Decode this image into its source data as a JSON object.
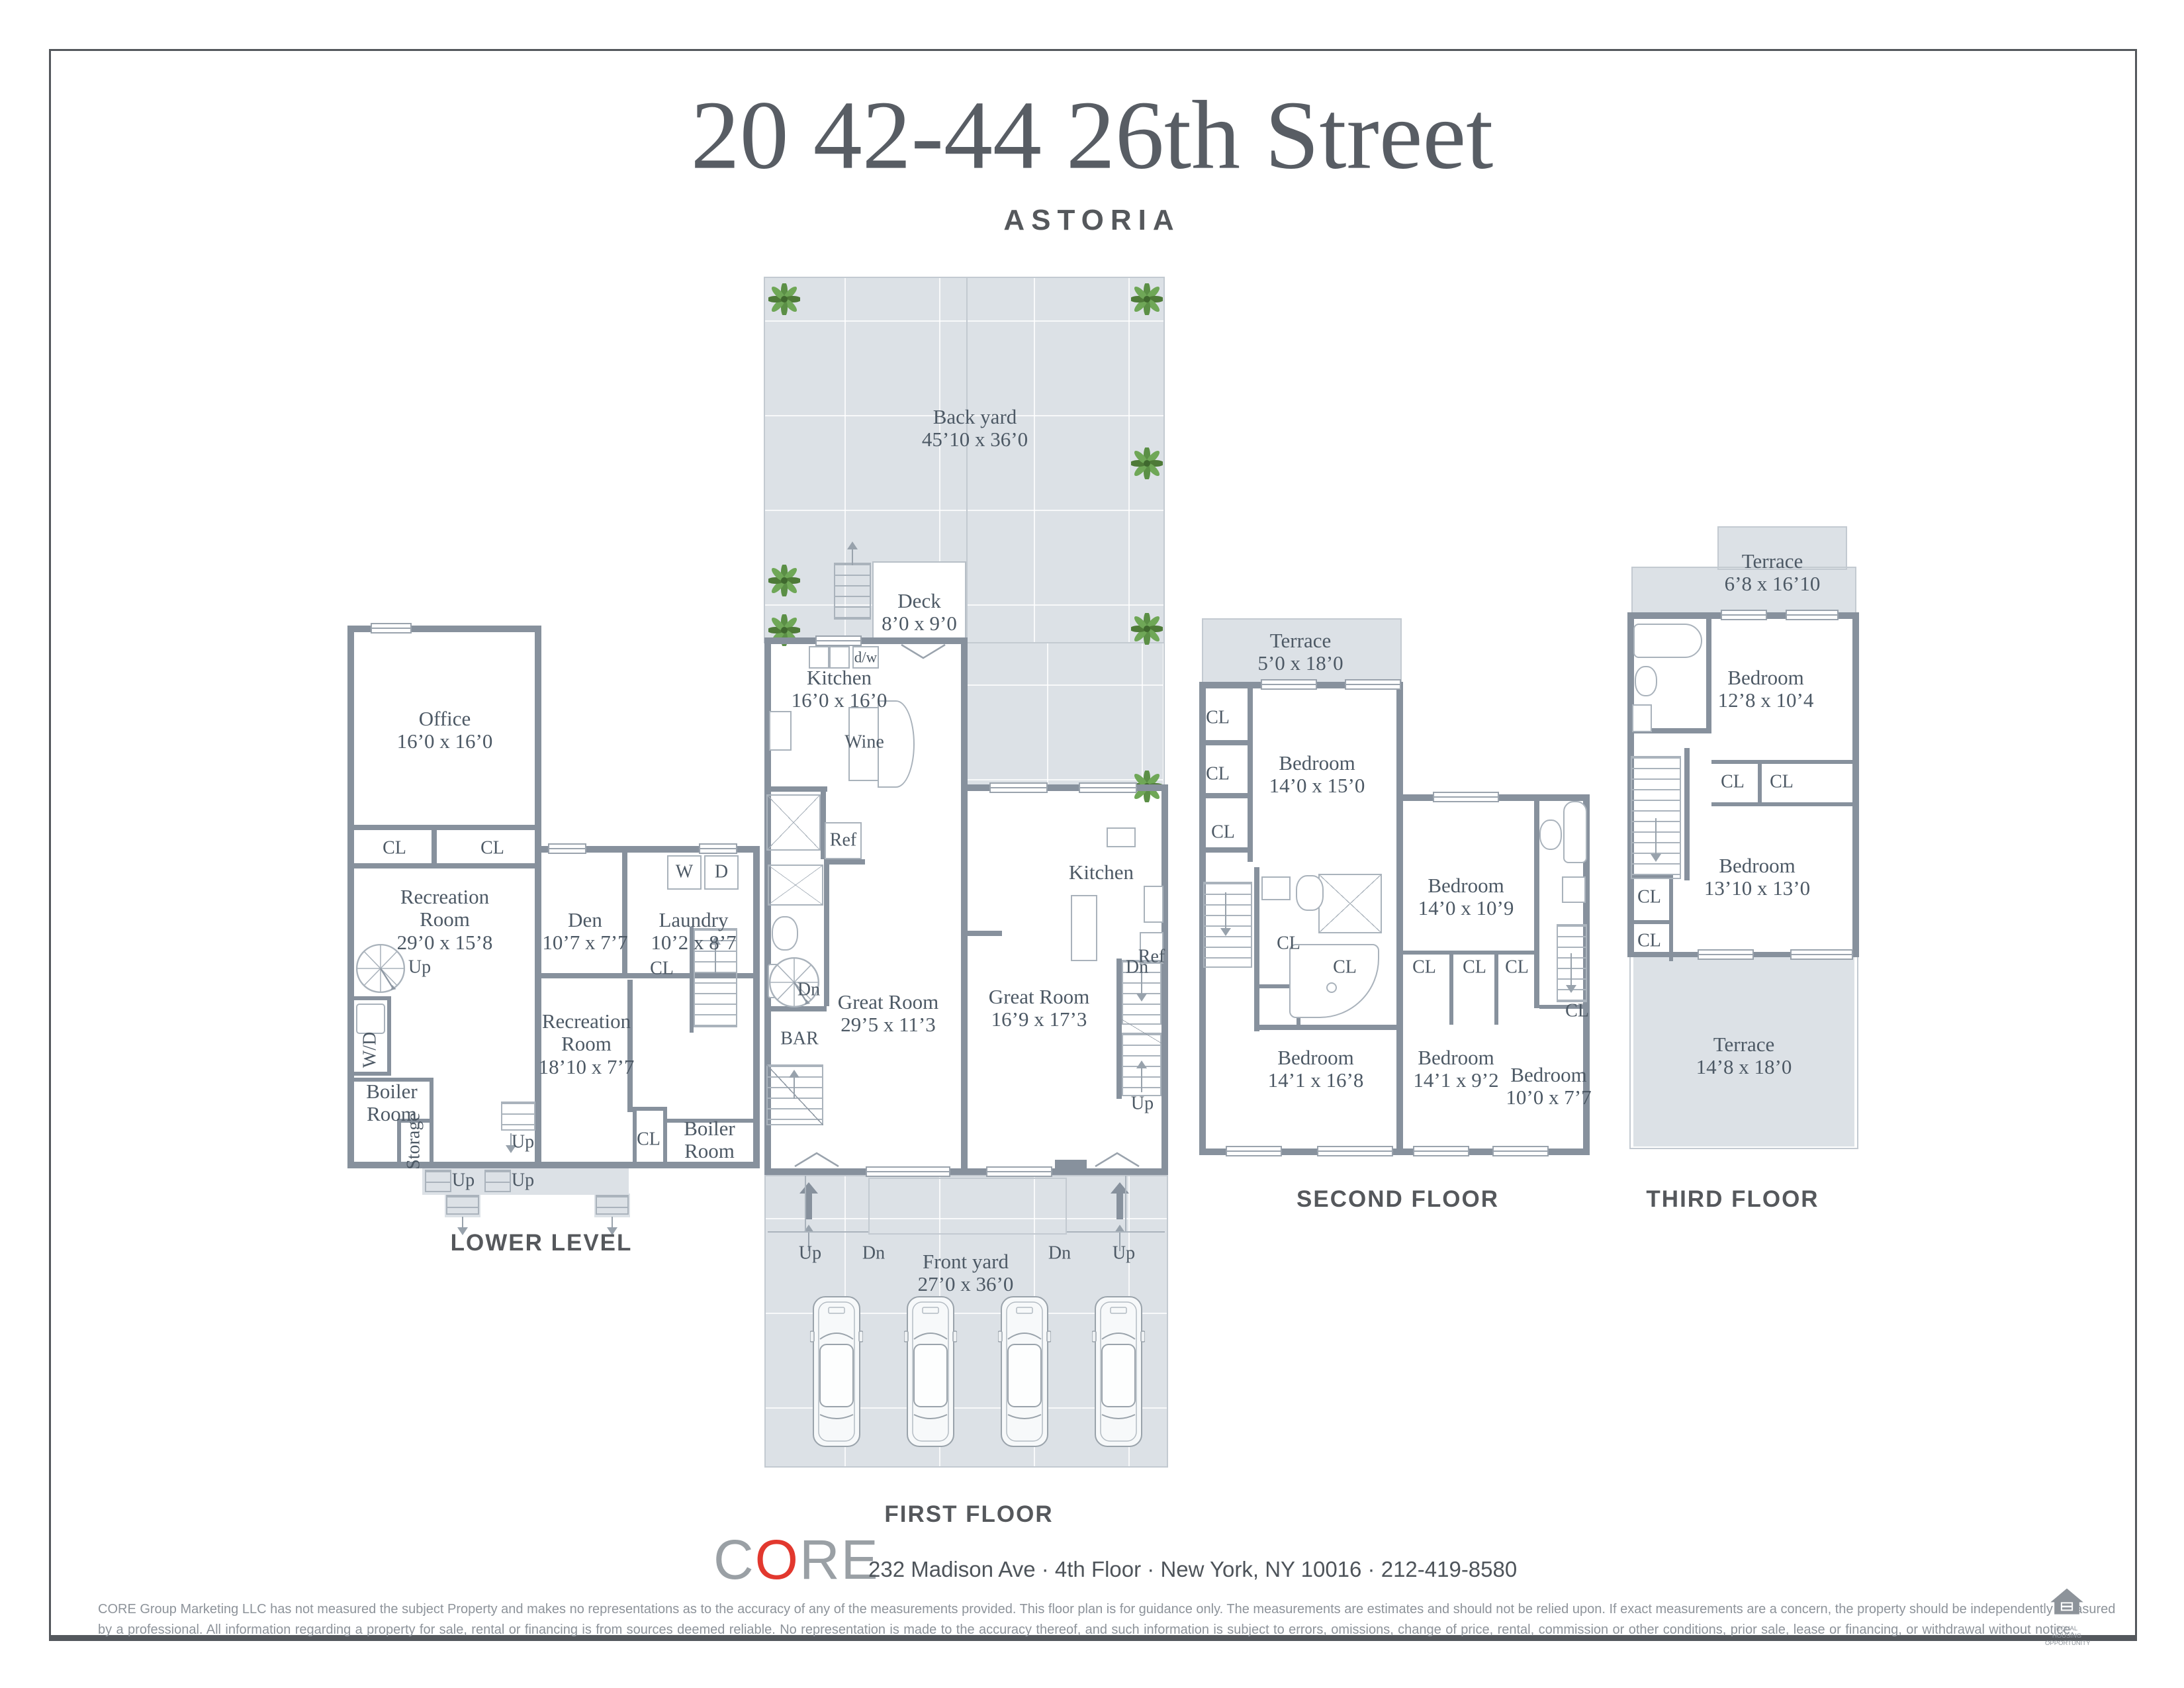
{
  "page": {
    "title": "20 42-44 26th Street",
    "subtitle": "ASTORIA"
  },
  "misc": {
    "cl": "CL",
    "up": "Up",
    "dn": "Dn",
    "w": "W",
    "d": "D",
    "wd": "W/D",
    "ref": "Ref",
    "wine": "Wine",
    "dw": "d/w",
    "bar": "BAR",
    "storage": "Storage"
  },
  "floors": {
    "lower": {
      "name": "LOWER LEVEL",
      "office": {
        "name": "Office",
        "dims": "16’0 x 16’0"
      },
      "rec1": {
        "name": "Recreation\nRoom",
        "dims": "29’0 x 15’8"
      },
      "rec2": {
        "name": "Recreation\nRoom",
        "dims": "18’10 x 7’7"
      },
      "den": {
        "name": "Den",
        "dims": "10’7 x 7’7"
      },
      "laundry": {
        "name": "Laundry",
        "dims": "10’2 x 8’7"
      },
      "boiler1": {
        "name": "Boiler\nRoom"
      },
      "boiler2": {
        "name": "Boiler\nRoom"
      }
    },
    "first": {
      "name": "FIRST FLOOR",
      "backyard": {
        "name": "Back yard",
        "dims": "45’10 x 36’0"
      },
      "deck": {
        "name": "Deck",
        "dims": "8’0 x 9’0"
      },
      "kitchenL": {
        "name": "Kitchen",
        "dims": "16’0 x 16’0"
      },
      "greatL": {
        "name": "Great Room",
        "dims": "29’5 x 11’3"
      },
      "kitchenR": {
        "name": "Kitchen"
      },
      "greatR": {
        "name": "Great Room",
        "dims": "16’9 x 17’3"
      },
      "front": {
        "name": "Front yard",
        "dims": "27’0 x 36’0"
      }
    },
    "second": {
      "name": "SECOND FLOOR",
      "terrace": {
        "name": "Terrace",
        "dims": "5’0 x 18’0"
      },
      "bed1": {
        "name": "Bedroom",
        "dims": "14’0 x 15’0"
      },
      "bed2": {
        "name": "Bedroom",
        "dims": "14’0 x 10’9"
      },
      "bed3": {
        "name": "Bedroom",
        "dims": "14’1 x 16’8"
      },
      "bed4": {
        "name": "Bedroom",
        "dims": "14’1 x 9’2"
      },
      "bed5": {
        "name": "Bedroom",
        "dims": "10’0 x 7’7"
      }
    },
    "third": {
      "name": "THIRD FLOOR",
      "terraceTop": {
        "name": "Terrace",
        "dims": "6’8 x 16’10"
      },
      "bed1": {
        "name": "Bedroom",
        "dims": "12’8 x 10’4"
      },
      "bed2": {
        "name": "Bedroom",
        "dims": "13’10 x 13’0"
      },
      "terraceBottom": {
        "name": "Terrace",
        "dims": "14’8 x 18’0"
      }
    }
  },
  "footer": {
    "brand_c": "C",
    "brand_o": "O",
    "brand_re": "RE",
    "address": "232 Madison Ave · 4th Floor · New York, NY 10016 · 212-419-8580",
    "disclaimer1": "CORE Group Marketing LLC has not measured the subject Property and makes no representations as to the accuracy of any of the measurements provided. This floor plan is for guidance only. The measurements are estimates and should not be relied upon. If exact measurements are a concern, the property should be independently measured",
    "disclaimer2": "by a professional. All information regarding a property for sale, rental or financing is from sources deemed reliable.  No representation is made to the accuracy thereof, and such information is subject to errors, omissions, change of price, rental, commission or other conditions, prior sale, lease or financing, or withdrawal without notice.",
    "equal_housing": "EQUAL HOUSING\nOPPORTUNITY"
  }
}
